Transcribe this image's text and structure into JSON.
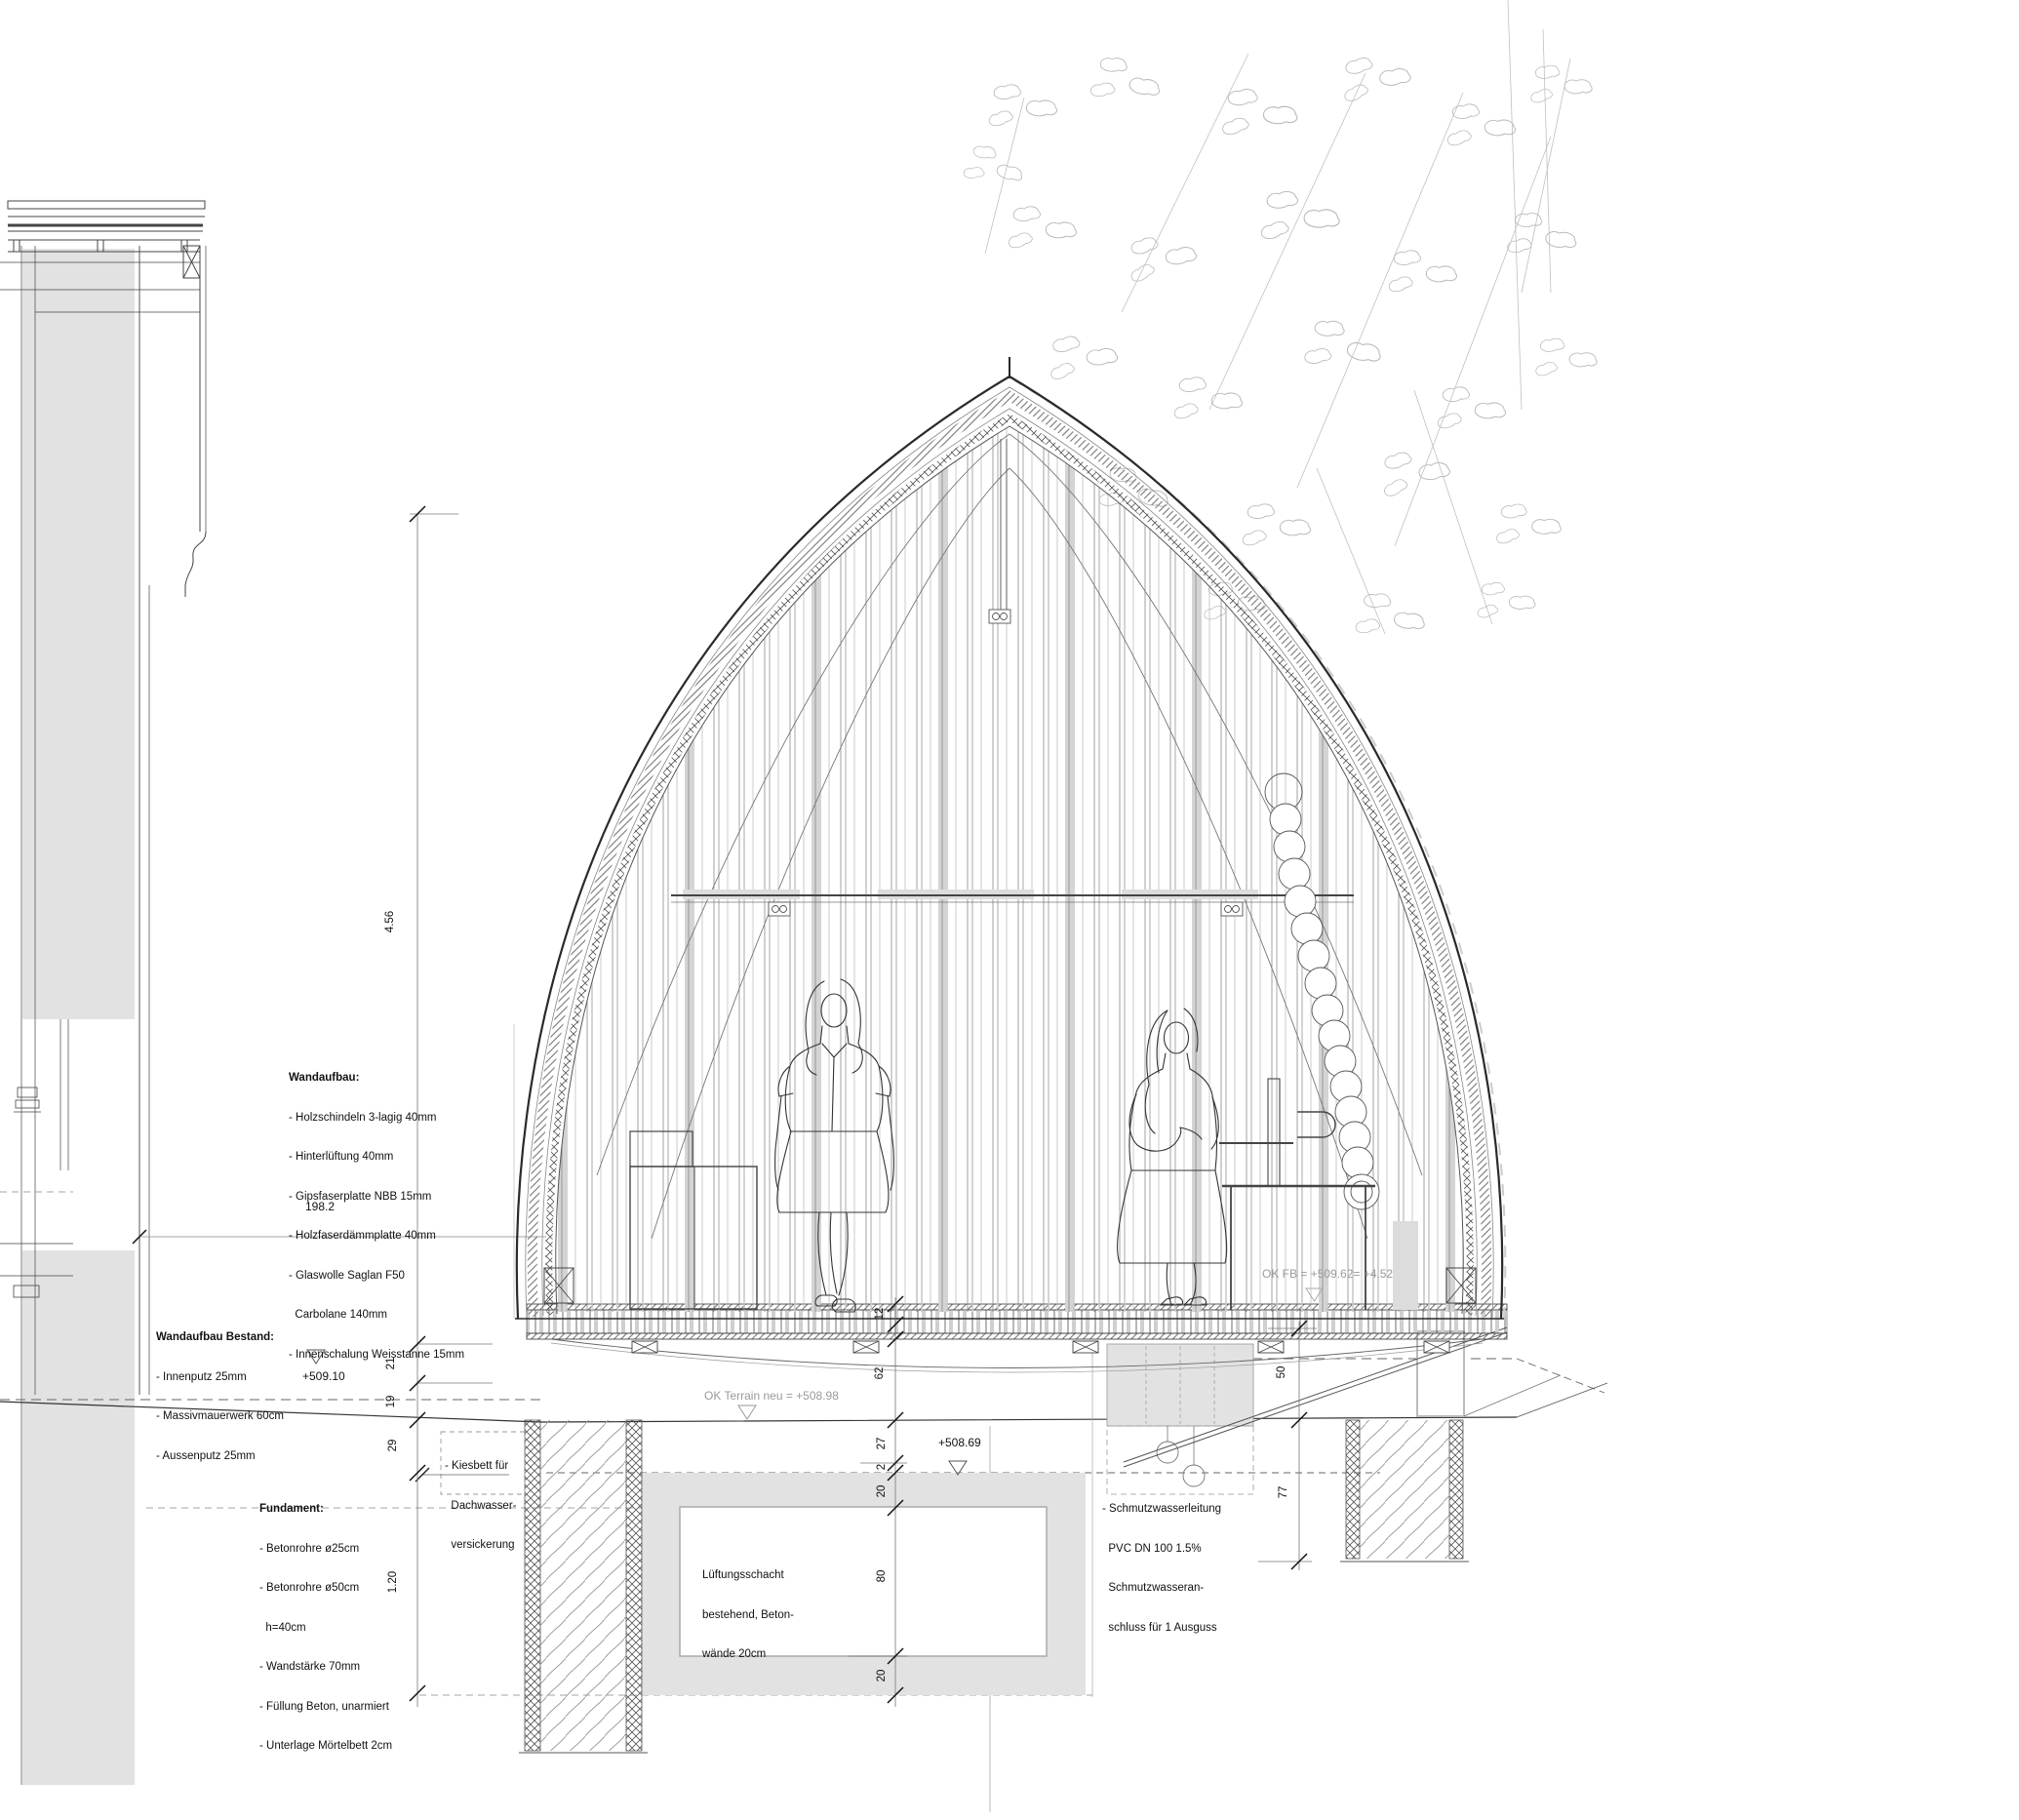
{
  "drawing_type": "building cross-section",
  "colors": {
    "background": "#ffffff",
    "gray_fill": "#e2e2e2",
    "dark_line": "#2a2a2a",
    "mid_line": "#777777",
    "tree_line": "#bcbcbc",
    "muted_text": "#9a9a9a",
    "text": "#111111"
  },
  "annotations": {
    "wandaufbau": {
      "title": "Wandaufbau:",
      "lines": [
        "- Holzschindeln 3-lagig 40mm",
        "- Hinterlüftung 40mm",
        "- Gipsfaserplatte NBB 15mm",
        "- Holzfaserdämmplatte 40mm",
        "- Glaswolle Saglan F50",
        "  Carbolane 140mm",
        "- Innenschalung Weisstanne 15mm"
      ]
    },
    "wandaufbau_bestand": {
      "title": "Wandaufbau Bestand:",
      "lines": [
        "- Innenputz 25mm",
        "- Massivmauerwerk 60cm",
        "- Aussenputz 25mm"
      ]
    },
    "fundament": {
      "title": "Fundament:",
      "lines": [
        "- Betonrohre ø25cm",
        "- Betonrohre ø50cm",
        "  h=40cm",
        "- Wandstärke 70mm",
        "- Füllung Beton, unarmiert",
        "- Unterlage Mörtelbett 2cm"
      ]
    },
    "kiesbett": {
      "lines": [
        "- Kiesbett für",
        "  Dachwasser-",
        "  versickerung"
      ]
    },
    "lueftungsschacht": {
      "lines": [
        "Lüftungsschacht",
        "bestehend, Beton-",
        "wände 20cm"
      ]
    },
    "schmutzwasser": {
      "lines": [
        "- Schmutzwasserleitung",
        "  PVC DN 100 1.5%",
        "  Schmutzwasseran-",
        "  schluss für 1 Ausguss"
      ]
    }
  },
  "levels": {
    "ok_terrain": "OK Terrain neu = +508.98",
    "ok_fb": "OK FB = +509.62= +4.52",
    "level_509_10": "+509.10",
    "level_508_69": "+508.69"
  },
  "dimensions": {
    "height_total": "4.56",
    "label_198": "198.2",
    "left_chain": [
      "21",
      "19",
      "29",
      "1.20"
    ],
    "mid_chain": [
      "12",
      "62",
      "27",
      "2",
      "20",
      "80",
      "20"
    ],
    "right_chain": [
      "50",
      "77"
    ]
  }
}
